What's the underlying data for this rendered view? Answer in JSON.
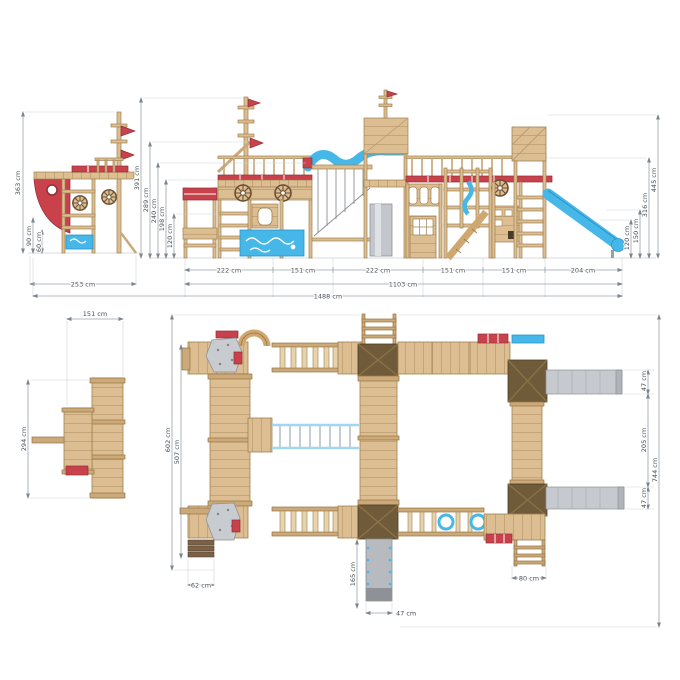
{
  "drawing": {
    "kind": "playground-assembly-technical-drawing",
    "unit": "cm",
    "side_elevation": {
      "height_total": "363 cm",
      "dim_90": "90 cm",
      "dim_60": "60 cm",
      "width_total": "253 cm"
    },
    "front_elevation": {
      "left_dims": [
        "391 cm",
        "289 cm",
        "240 cm",
        "198 cm",
        "120 cm"
      ],
      "bottom_segments": [
        "222 cm",
        "151 cm",
        "222 cm",
        "151 cm",
        "151 cm",
        "204 cm"
      ],
      "subtotal": "1103 cm",
      "total": "1488 cm",
      "right_dims": [
        "445 cm",
        "316 cm",
        "150 cm",
        "120 cm"
      ]
    },
    "side_plan": {
      "width": "151 cm",
      "depth": "294 cm"
    },
    "top_plan": {
      "left_outer": "602 cm",
      "left_inner": "507 cm",
      "right_slide_top": "47 cm",
      "right_gap": "205 cm",
      "right_total": "744 cm",
      "right_slide_bottom": "47 cm",
      "steps_width": "62 cm",
      "slide_length": "165 cm",
      "slide_width": "47 cm",
      "ladder_width": "80 cm"
    },
    "colors": {
      "wood": "#dcbe92",
      "wood_dark": "#cba97a",
      "accent_red": "#c8414b",
      "slide_blue": "#45b7e8",
      "slide_gray": "#c6cacf",
      "roof_brown": "#6f5a39",
      "dimension_line": "#9aa3ab",
      "dimension_text": "#474e55"
    }
  }
}
